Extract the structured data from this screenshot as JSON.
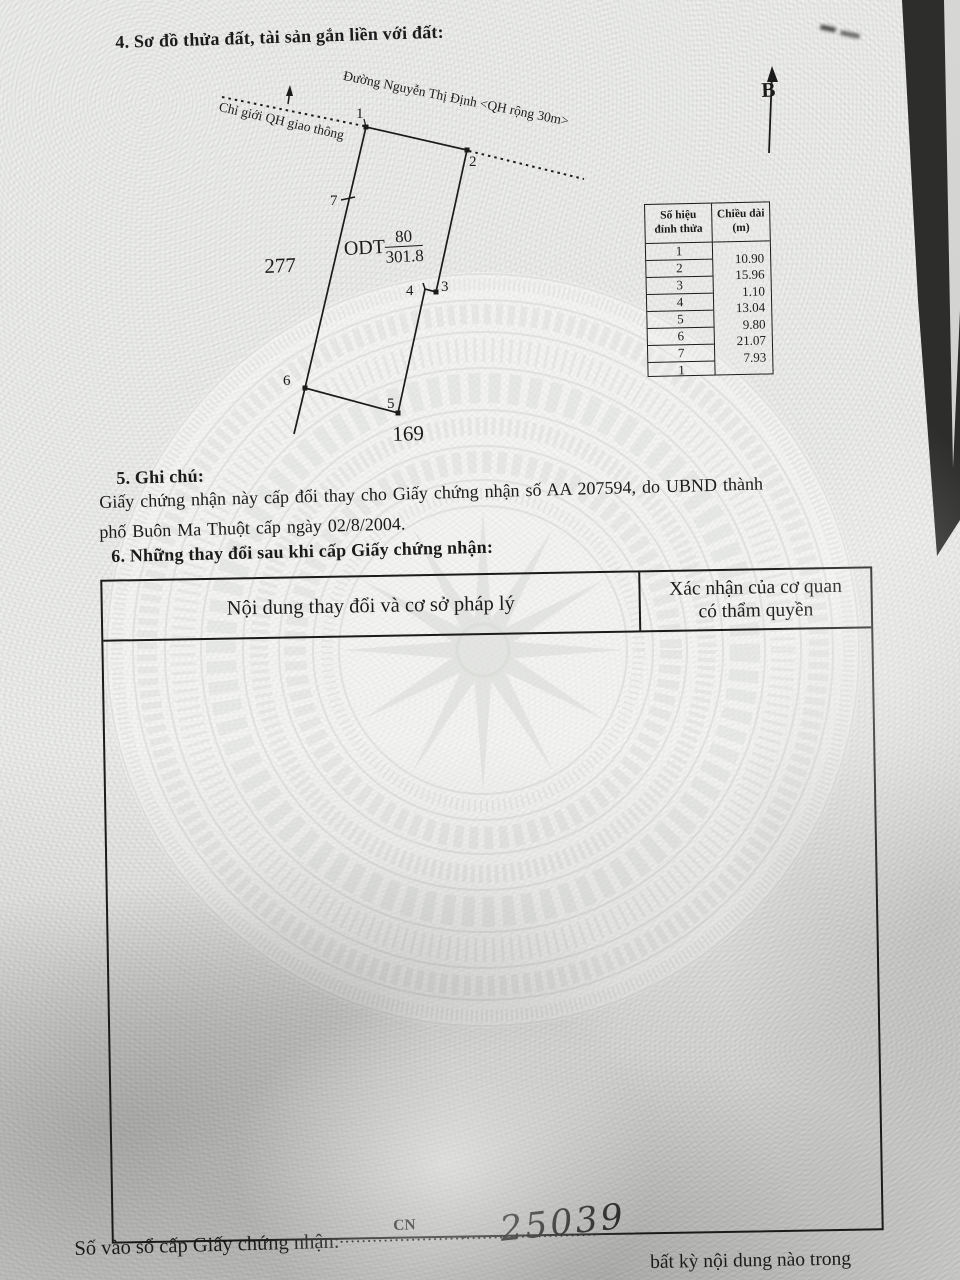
{
  "document": {
    "section4": {
      "title": "4. Sơ đồ thửa đất, tài sản gắn liền với đất:"
    },
    "diagram": {
      "road_label": "Đường Nguyễn Thị Định <QH rộng 30m>",
      "boundary_label": "Chỉ giới QH giao thông",
      "north_label": "B",
      "plot_code": "ODT",
      "plot_number": "80",
      "plot_area": "301.8",
      "adjacent_parcel_left": "277",
      "adjacent_parcel_bottom": "169",
      "vertex_labels": [
        "1",
        "2",
        "3",
        "4",
        "5",
        "6",
        "7"
      ]
    },
    "vertex_table": {
      "header_col1_line1": "Số hiệu",
      "header_col1_line2": "đỉnh thửa",
      "header_col2_line1": "Chiều dài",
      "header_col2_line2": "(m)",
      "vertex_numbers": [
        "1",
        "2",
        "3",
        "4",
        "5",
        "6",
        "7",
        "1"
      ],
      "lengths": [
        "10.90",
        "15.96",
        "1.10",
        "13.04",
        "9.80",
        "21.07",
        "7.93"
      ]
    },
    "section5": {
      "title": "5. Ghi chú:",
      "line1": "Giấy chứng nhận này cấp đổi thay cho Giấy chứng nhận số AA 207594, do UBND thành",
      "line2": "phố Buôn Ma Thuột cấp ngày 02/8/2004."
    },
    "section6": {
      "title": "6. Những thay đổi sau khi cấp Giấy chứng nhận:",
      "col1_header": "Nội dung thay đổi và cơ sở pháp lý",
      "col2_header_line1": "Xác nhận của cơ quan",
      "col2_header_line2": "có thẩm quyền"
    },
    "footer": {
      "register_label": "Số vào sổ cấp Giấy chứng nhận:",
      "leader_dots": "....................................................",
      "cn_label": "CN",
      "dash": "-",
      "register_number": "25039",
      "partial_bottom_text": "bất kỳ nội dung nào trong"
    }
  }
}
